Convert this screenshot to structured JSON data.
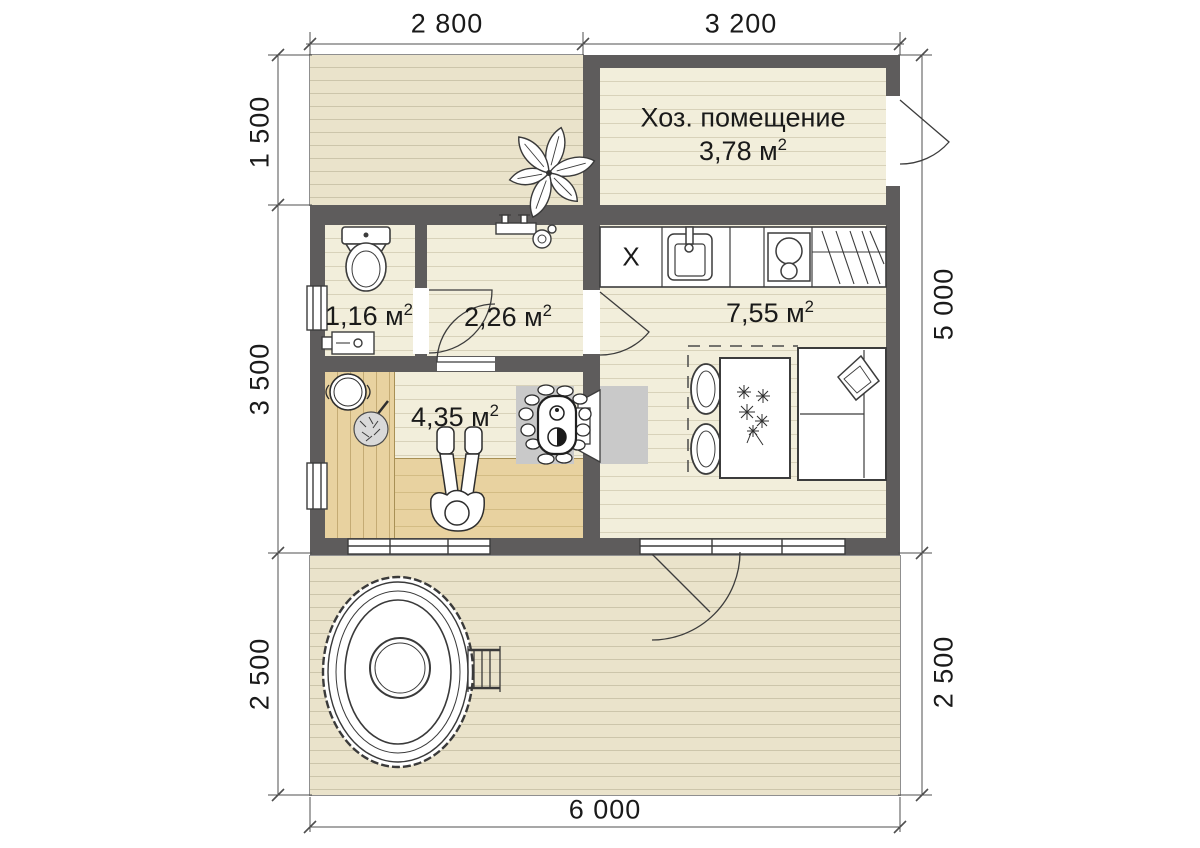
{
  "plan": {
    "dimensions": {
      "top_left": "2 800",
      "top_right": "3 200",
      "left_top": "1 500",
      "left_middle": "3 500",
      "left_bottom": "2 500",
      "right_top": "5 000",
      "right_bottom": "2 500",
      "bottom": "6 000"
    },
    "rooms": {
      "utility": {
        "name": "Хоз. помещение",
        "area": "3,78 м",
        "sup": "2"
      },
      "wc": {
        "area": "1,16 м",
        "sup": "2"
      },
      "hall": {
        "area": "2,26 м",
        "sup": "2"
      },
      "kitchen": {
        "area": "7,55 м",
        "sup": "2",
        "counter_mark": "X"
      },
      "sauna": {
        "area": "4,35 м",
        "sup": "2"
      }
    },
    "colors": {
      "wall": "#5e5c5c",
      "room_floor": "#f2eedb",
      "deck": "#eae3cb",
      "sauna_bench": "#e8d2a0",
      "hearth": "#c9c9c9",
      "line_art": "#3c3c3c"
    }
  }
}
